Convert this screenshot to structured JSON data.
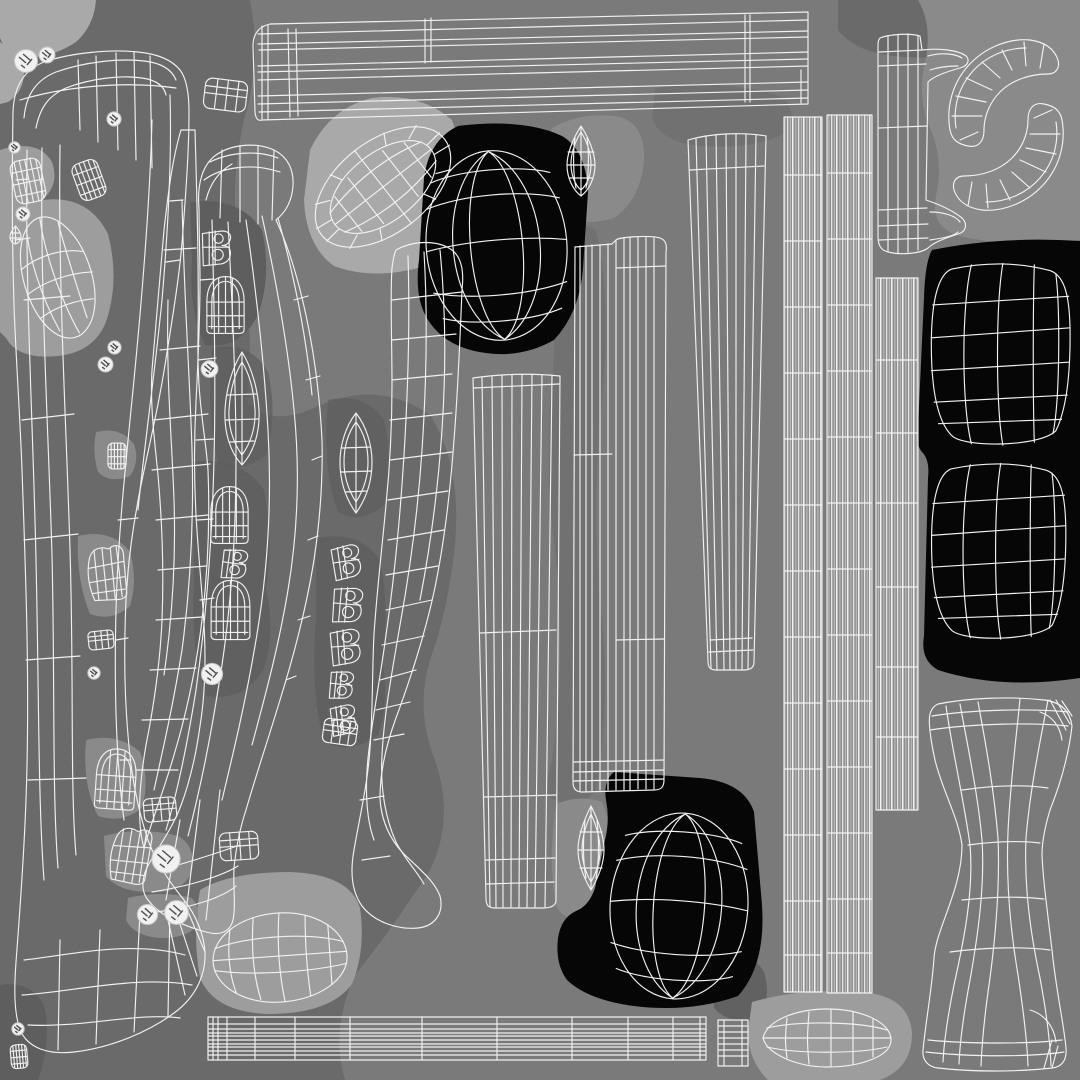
{
  "meta": {
    "description": "Wireframe UV-unwrap texture layout sheet of a 3D model; no text, a grid of white mesh islands over gray, light-gray and black patches",
    "image_type": "uv-wireframe-layout",
    "canvas": {
      "width": 1080,
      "height": 1080
    }
  },
  "colors": {
    "background": "#7a7a7a",
    "shade_dark": "#6a6a6a",
    "shade_darker": "#5e5e5e",
    "shade_light": "#9d9d9d",
    "shade_lighter": "#a9a9a9",
    "shade_mid": "#8a8a8a",
    "black_patch": "#060606",
    "wire": "#f1f1f1",
    "wire_dim": "#c6c6c6",
    "strip_fill": "#8f8f8f"
  },
  "islands": [
    {
      "id": "top-molding-strip",
      "label": "long horizontal molding strip, top"
    },
    {
      "id": "left-hook-band",
      "label": "large hooked band ending in boot-like foot, left edge"
    },
    {
      "id": "ladder-band",
      "label": "narrow ladder band, left middle"
    },
    {
      "id": "thumb-hook-band",
      "label": "thumb-shaped hook band with heel end"
    },
    {
      "id": "s-curve-band",
      "label": "S-curved band with rounded tip"
    },
    {
      "id": "bun-ring",
      "label": "tilted oval ring with grid on light patch"
    },
    {
      "id": "sphere-top",
      "label": "sphere wireframe on black patch, top center"
    },
    {
      "id": "eye-lens-top",
      "label": "vertical lens / eye shape, top center"
    },
    {
      "id": "eye-lens-bottom",
      "label": "vertical lens / eye shape, bottom center"
    },
    {
      "id": "plank-strip",
      "label": "bent plank strip, center"
    },
    {
      "id": "tapered-strip",
      "label": "tapered vertical strip, center"
    },
    {
      "id": "tapered-strip-right",
      "label": "tapered vertical strip, upper right of center"
    },
    {
      "id": "t-molding-piece",
      "label": "T-profile molding piece, top right"
    },
    {
      "id": "crescent-pair",
      "label": "two interlocking crescent bands, top right corner"
    },
    {
      "id": "dense-strip-a",
      "label": "dense striped band, right, column 1"
    },
    {
      "id": "dense-strip-b",
      "label": "dense striped band, right, column 2"
    },
    {
      "id": "dense-strip-c",
      "label": "short dense striped band, far right"
    },
    {
      "id": "dome-sphere-upper",
      "label": "squarish sphere wireframe on black, right upper"
    },
    {
      "id": "dome-sphere-lower",
      "label": "squarish sphere wireframe on black, right lower"
    },
    {
      "id": "sphere-bottom",
      "label": "sphere wireframe on black patch, bottom center"
    },
    {
      "id": "hourglass-piece",
      "label": "hourglass / furniture-leg profile, bottom right"
    },
    {
      "id": "egg-oval-left",
      "label": "gridded egg oval, bottom left"
    },
    {
      "id": "loaf-oval-bottom",
      "label": "gridded loaf oval, bottom"
    },
    {
      "id": "bottom-rail",
      "label": "long thin rail strip along bottom"
    },
    {
      "id": "potato-shape",
      "label": "gridded potato shape, upper left"
    },
    {
      "id": "toe-pieces",
      "label": "scattered small toe / pad / eyelet pieces"
    }
  ]
}
